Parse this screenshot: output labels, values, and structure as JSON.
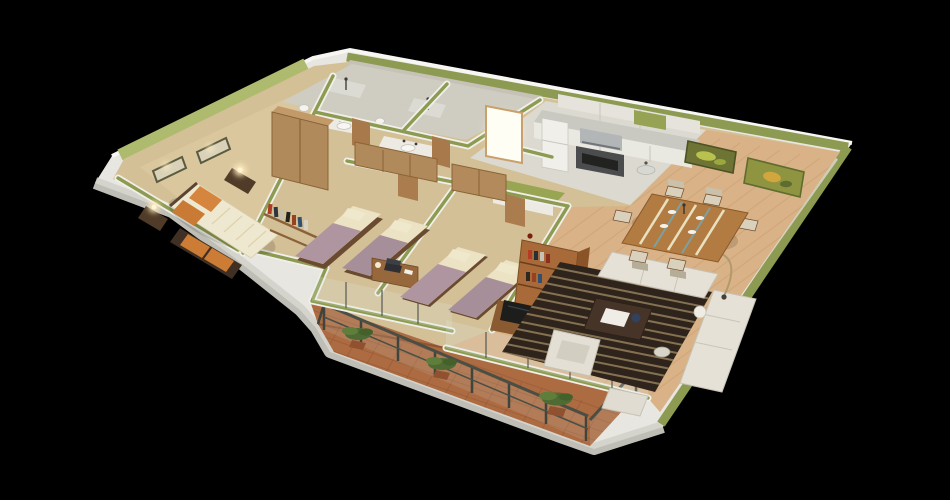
{
  "scene": {
    "type": "3d-isometric-floor-plan-render",
    "description": "3D cutaway floor plan of a three-bedroom apartment with balcony, rendered from above on a black background",
    "rooms": [
      {
        "name": "master-bedroom",
        "furnishings": [
          "double-bed",
          "orange-pillows",
          "storage-bench",
          "wardrobe",
          "nightstand-lamps",
          "wall-pictures",
          "book-shelf"
        ]
      },
      {
        "name": "bedroom-2",
        "furnishings": [
          "single-bed",
          "single-bed",
          "wardrobe",
          "desk-with-laptop"
        ]
      },
      {
        "name": "bedroom-3",
        "furnishings": [
          "single-bed",
          "single-bed",
          "wardrobe"
        ]
      },
      {
        "name": "bathroom-1",
        "furnishings": [
          "shower",
          "sink-counter",
          "toilet"
        ]
      },
      {
        "name": "bathroom-2",
        "furnishings": [
          "shower",
          "sink-counter",
          "toilet"
        ]
      },
      {
        "name": "kitchen",
        "furnishings": [
          "fridge",
          "range-hood",
          "stove-oven",
          "counter",
          "upper-cabinets",
          "sink"
        ]
      },
      {
        "name": "dining-area",
        "furnishings": [
          "dining-table",
          "six-chairs",
          "wall-art",
          "wall-art"
        ]
      },
      {
        "name": "living-room",
        "furnishings": [
          "striped-rug",
          "sofa",
          "armchair",
          "coffee-table",
          "side-table",
          "tv-sideboard",
          "bookshelf",
          "floor-lamp"
        ]
      },
      {
        "name": "hallway",
        "furnishings": [
          "entry-door-glowing"
        ]
      },
      {
        "name": "balcony",
        "furnishings": [
          "metal-glass-railing",
          "potted-plant",
          "potted-plant",
          "potted-plant"
        ]
      }
    ],
    "palette": {
      "background": "#000000",
      "outer_wall": "#e8e6e0",
      "outer_wall_rim": "#f7f6f2",
      "outer_wall_shade": "#d3d1ca",
      "wall_top_green": "#8c9b51",
      "wall_top_green_light": "#aebb6e",
      "interior_wall": "#f1efe9",
      "carpet": "#d4c096",
      "carpet_master": "#dac79e",
      "wood_floor": "#d9b287",
      "kitchen_floor": "#dcd9d0",
      "bathroom_floor": "#cfccc2",
      "bathroom_wall": "#c7c2b7",
      "balcony_tile": "#ad6b42",
      "rug": "#2f241b",
      "sofa": "#e5e1d6",
      "bed_duvet": "#efe8d0",
      "pillow_orange": "#d5853e",
      "blanket_mauve": "#ae95a0",
      "furniture_wood": "#b18a5c",
      "bookshelf_wood": "#a86a38",
      "door_wood": "#aa7c4e",
      "railing_metal": "#4a4f45",
      "plant_green": "#4f6b33",
      "lamp_glow": "#ffe9b8"
    }
  }
}
